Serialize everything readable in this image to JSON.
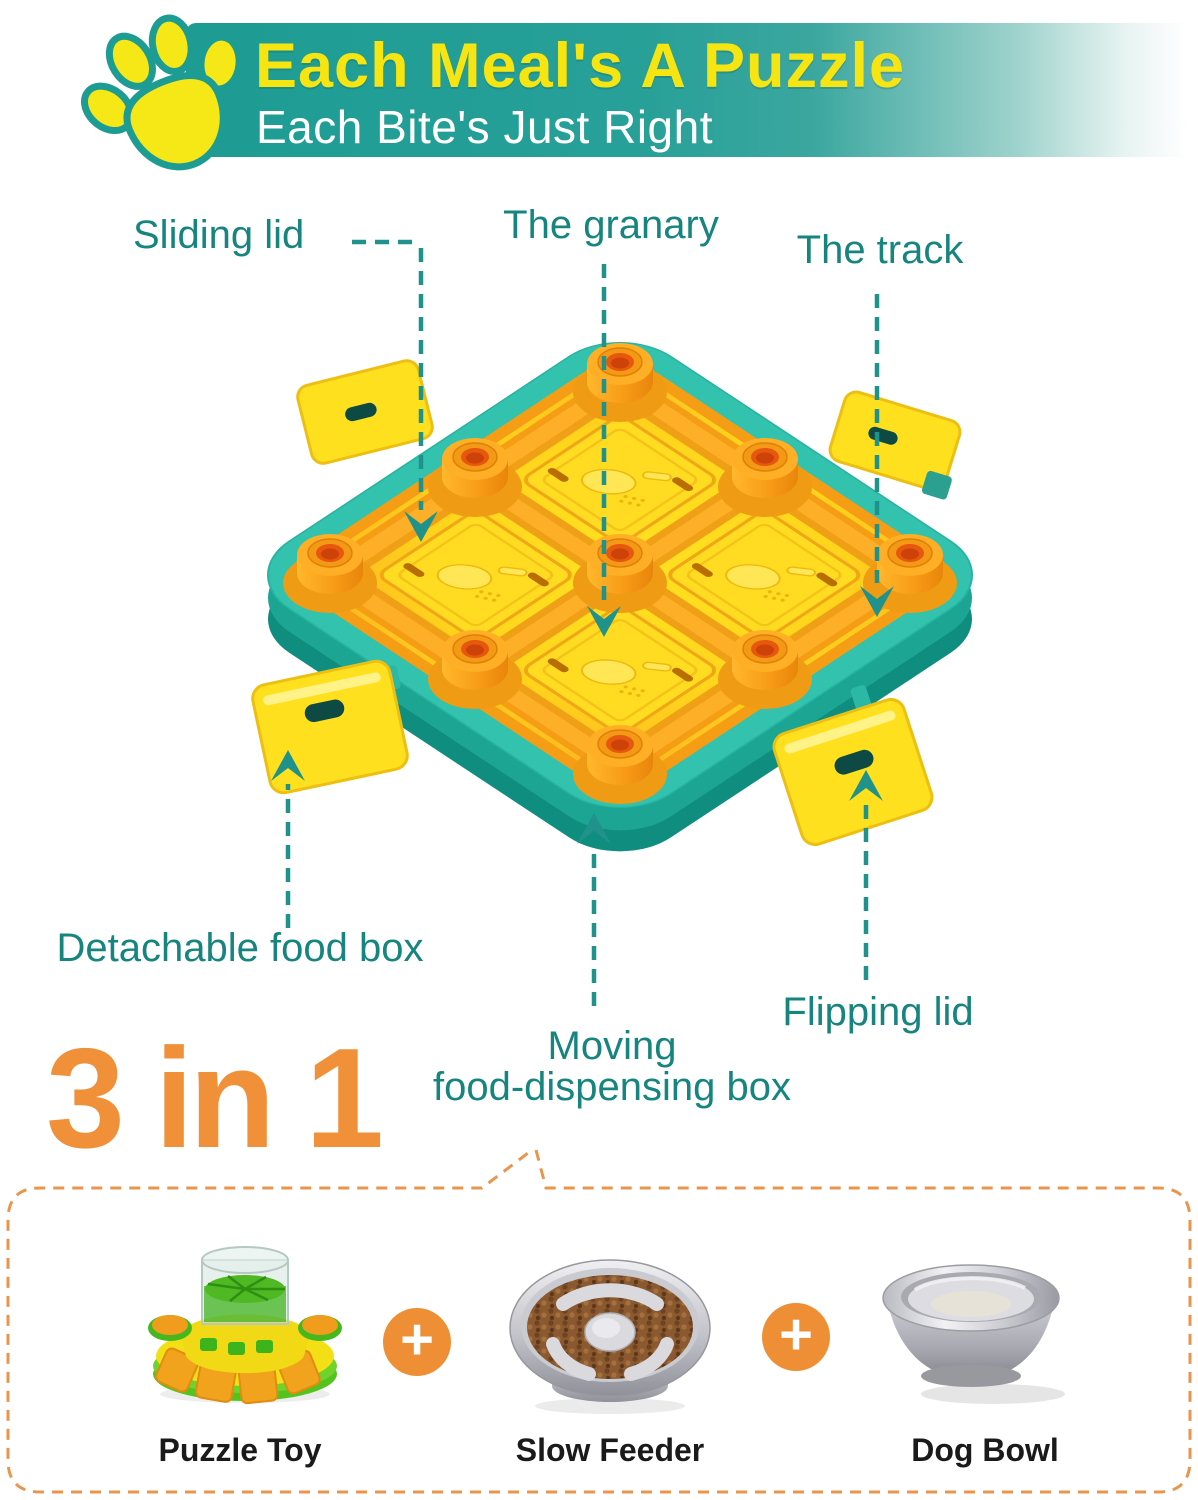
{
  "banner": {
    "title": "Each Meal's A Puzzle",
    "subtitle": "Each Bite's Just Right"
  },
  "callouts": {
    "sliding_lid": "Sliding lid",
    "granary": "The granary",
    "track": "The track",
    "detachable": "Detachable food box",
    "moving_line1": "Moving",
    "moving_line2": "food-dispensing box",
    "flipping_lid": "Flipping lid"
  },
  "combo": {
    "heading": "3 in 1",
    "plus": "+",
    "items": [
      {
        "label": "Puzzle Toy"
      },
      {
        "label": "Slow Feeder"
      },
      {
        "label": "Dog Bowl"
      }
    ]
  },
  "icons": {
    "paw": "paw-icon",
    "plus": "plus-icon",
    "arrow": "dashed-arrow-icon"
  },
  "colors": {
    "banner_teal": "#1d9c94",
    "title_yellow": "#f7e512",
    "label_teal": "#17857f",
    "arrow_teal": "#1f938b",
    "tray_teal": "#32c2ae",
    "surface_yellow": "#ffd91c",
    "knob_orange": "#f59d1f",
    "heading_orange": "#f0913a",
    "dashed_border_orange": "#e8964e",
    "plus_orange": "#ee8f35"
  }
}
